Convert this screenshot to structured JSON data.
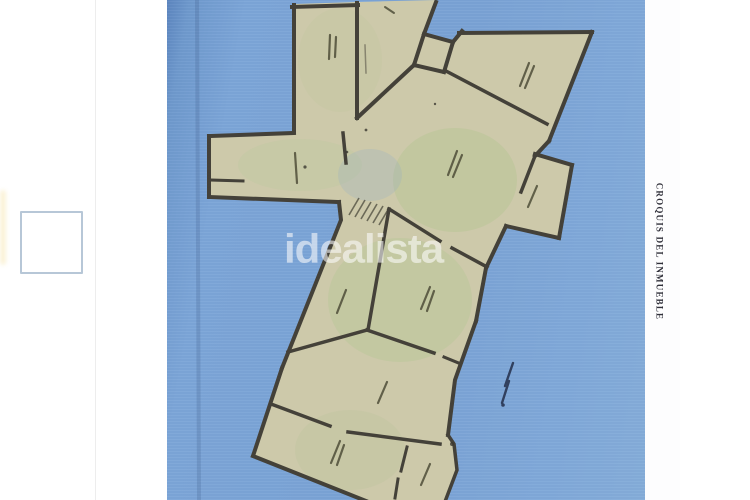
{
  "watermark": {
    "text": "idealista",
    "color": "rgba(255,255,255,0.58)"
  },
  "floorplan": {
    "caption": "CROQUIS DEL INMUEBLE",
    "caption_color": "#30303a",
    "scan_background_color": "#7aa3d5",
    "room_fill_color": "#cbc8a9",
    "wall_color": "#45423a",
    "illegible_room_labels": true
  },
  "left_panel": {
    "thumbnail_box_border_color": "#b7c7d7"
  }
}
